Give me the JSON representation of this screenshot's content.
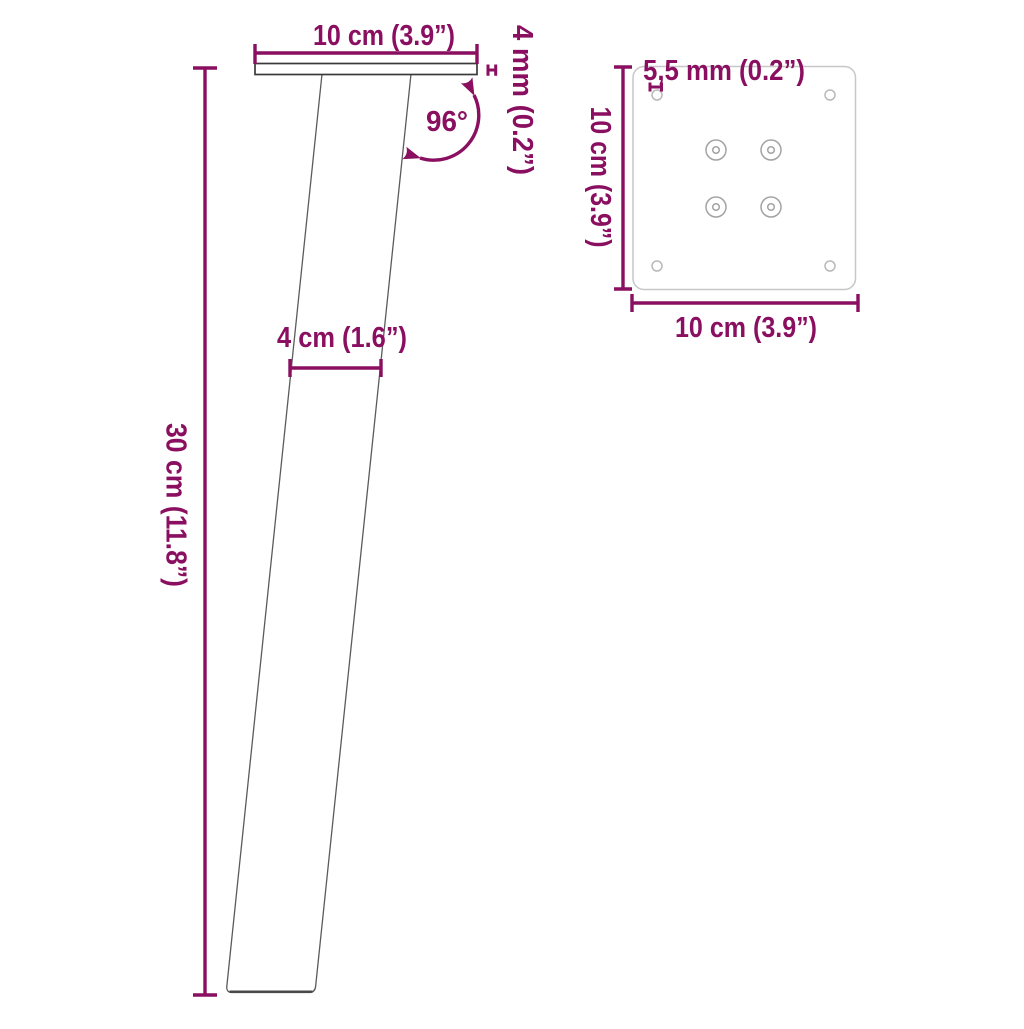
{
  "figure": {
    "accent_color": "#8a0f60",
    "side_view": {
      "top_width": "10 cm (3.9”)",
      "plate_thickness": "4 mm (0.2”)",
      "angle": "96°",
      "leg_width": "4 cm (1.6”)",
      "height": "30 cm (11.8”)"
    },
    "top_view": {
      "hole_diameter": "5,5 mm (0.2”)",
      "plate_depth": "10 cm (3.9”)",
      "plate_width": "10 cm (3.9”)"
    }
  }
}
